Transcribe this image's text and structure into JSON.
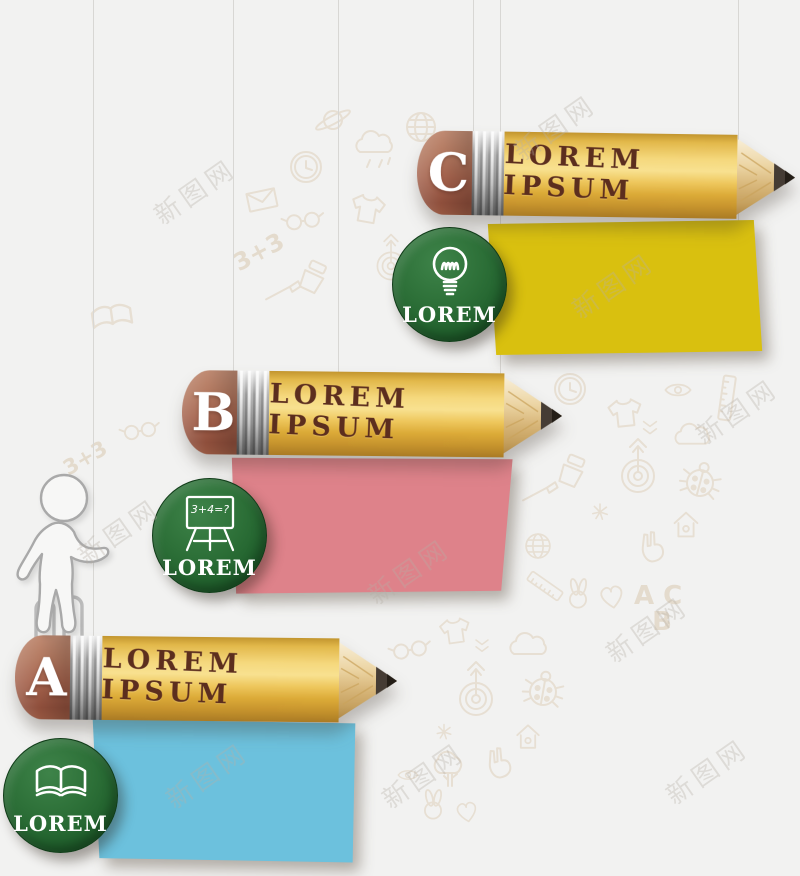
{
  "watermark": {
    "text": "新图网"
  },
  "background_doodles": {
    "sum_text": "3+3",
    "abc_text": "A C\n  B",
    "icons": [
      "clock",
      "envelope",
      "glasses",
      "saturn",
      "globe",
      "cloud",
      "rain-cloud",
      "t-shirt",
      "target",
      "ladybug",
      "heart",
      "house",
      "tree",
      "ruler",
      "eye",
      "chevron",
      "open-book",
      "paintbrush",
      "paint-tube",
      "peace-hand",
      "rabbit",
      "leaf"
    ]
  },
  "options": [
    {
      "letter": "C",
      "label": "LOREM IPSUM",
      "badge": {
        "label": "LOREM",
        "icon": "lightbulb"
      },
      "note_color": "#d9c00f"
    },
    {
      "letter": "B",
      "label": "LOREM IPSUM",
      "badge": {
        "label": "LOREM",
        "icon": "chalkboard",
        "board_text": "3+4=?"
      },
      "note_color": "#de828a"
    },
    {
      "letter": "A",
      "label": "LOREM IPSUM",
      "badge": {
        "label": "LOREM",
        "icon": "open-book"
      },
      "note_color": "#6cc1dd"
    }
  ],
  "colors": {
    "background": "#f2f2f1",
    "pencil_body_gold": "#eec75d",
    "eraser_brown": "#a5634d",
    "ferrule_silver": "#c9c9c9",
    "label_text_brown": "#5c2e1e",
    "badge_green": "#2d7038",
    "badge_text": "#ffffff",
    "note_yellow": "#d9c00f",
    "note_pink": "#de828a",
    "note_blue": "#6cc1dd",
    "string_gray": "#d8d7d4",
    "doodle_tan": "#e7dfd3"
  }
}
